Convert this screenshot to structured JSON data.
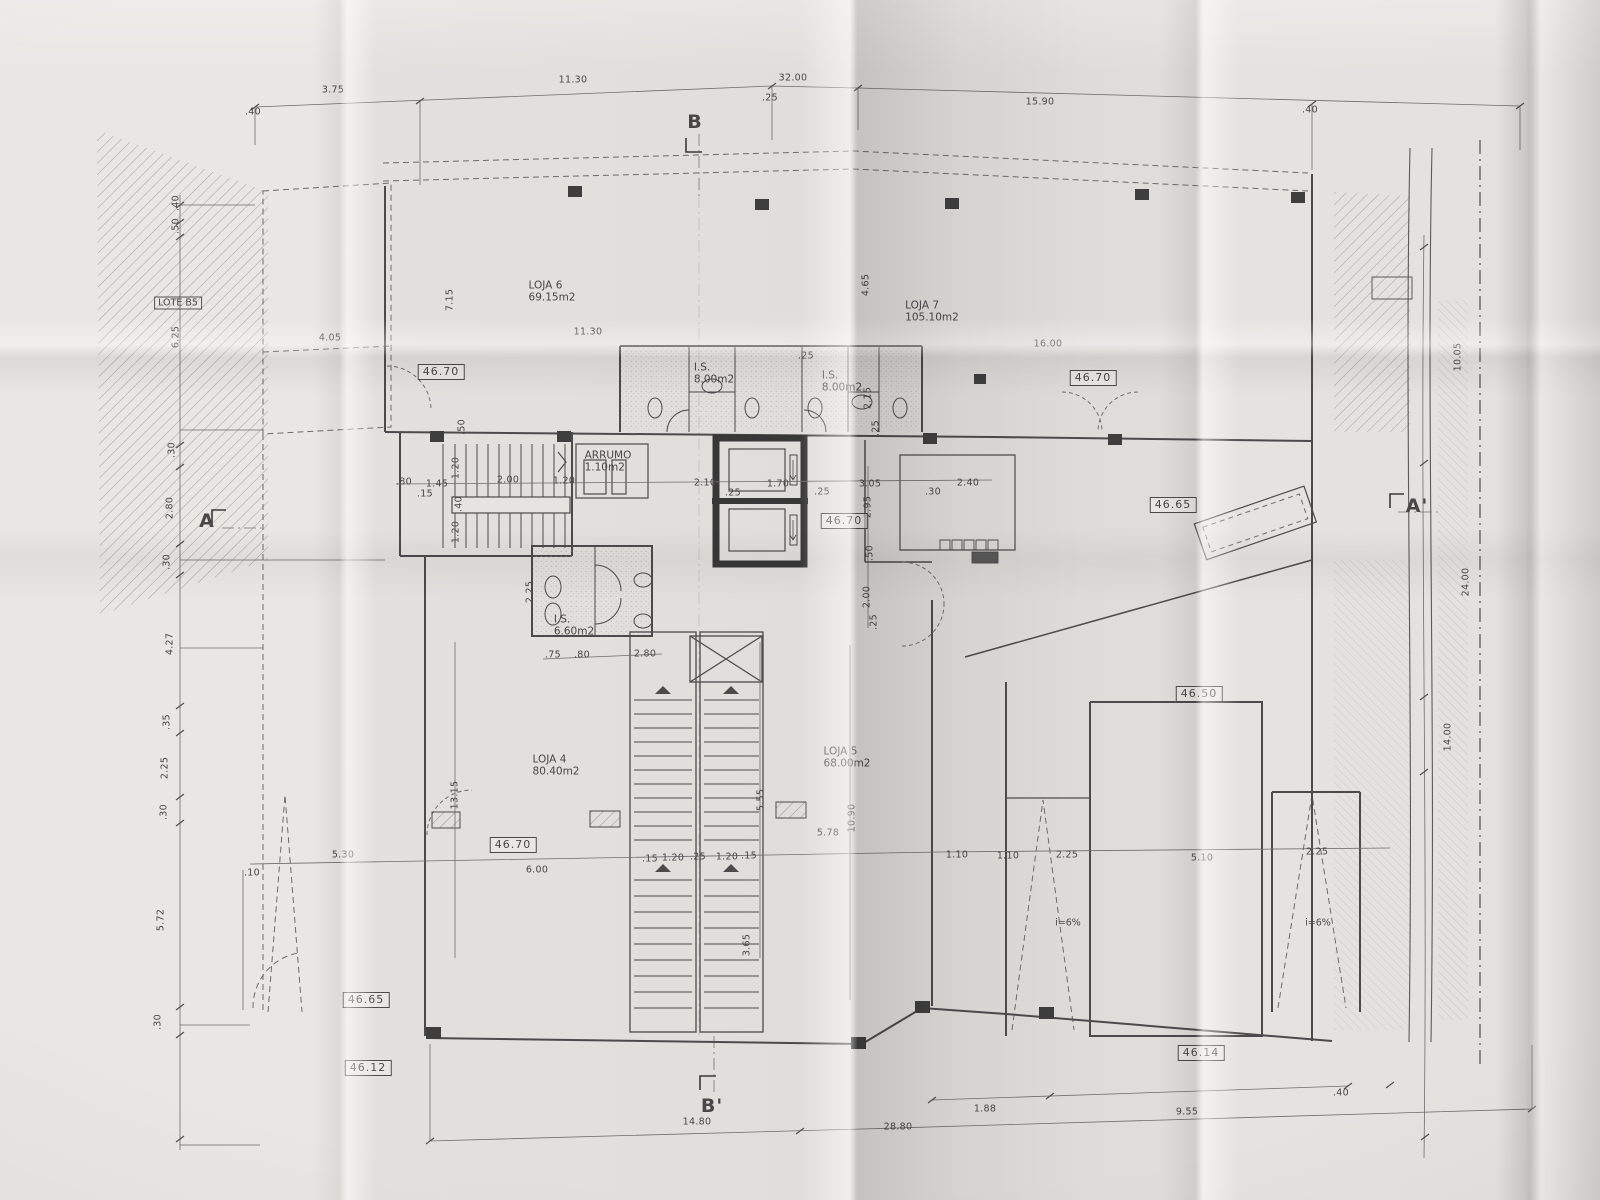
{
  "drawing": {
    "kind_note": "folded paper print of a ground-floor architectural plan",
    "accent_line_color": "#4b4b4b",
    "paper_color": "#e3e1de"
  },
  "annotations": {
    "rooms": [
      {
        "t": "LOJA 6",
        "t2": "69.15m2",
        "x": 552,
        "y": 292
      },
      {
        "t": "LOJA 7",
        "t2": "105.10m2",
        "x": 932,
        "y": 312
      },
      {
        "t": "LOJA 4",
        "t2": "80.40m2",
        "x": 556,
        "y": 766
      },
      {
        "t": "LOJA 5",
        "t2": "68.00m2",
        "x": 847,
        "y": 758
      },
      {
        "t": "I.S.",
        "t2": "8.00m2",
        "x": 714,
        "y": 374
      },
      {
        "t": "I.S.",
        "t2": "8.00m2",
        "x": 842,
        "y": 382
      },
      {
        "t": "I.S.",
        "t2": "6.60m2",
        "x": 574,
        "y": 626
      },
      {
        "t": "ARRUMO",
        "t2": "1.10m2",
        "x": 608,
        "y": 462
      }
    ],
    "levels": [
      {
        "t": "46.70",
        "x": 441,
        "y": 372
      },
      {
        "t": "46.70",
        "x": 1093,
        "y": 378
      },
      {
        "t": "46.70",
        "x": 844,
        "y": 521
      },
      {
        "t": "46.65",
        "x": 1173,
        "y": 505
      },
      {
        "t": "46.50",
        "x": 1199,
        "y": 694
      },
      {
        "t": "46.70",
        "x": 513,
        "y": 845
      },
      {
        "t": "46.65",
        "x": 366,
        "y": 1000
      },
      {
        "t": "46.12",
        "x": 368,
        "y": 1068
      },
      {
        "t": "46.14",
        "x": 1201,
        "y": 1053
      }
    ],
    "sections": [
      {
        "t": "B",
        "x": 695,
        "y": 122
      },
      {
        "t": "B'",
        "x": 712,
        "y": 1106
      },
      {
        "t": "A",
        "x": 207,
        "y": 521
      },
      {
        "t": "A'",
        "x": 1417,
        "y": 506
      }
    ],
    "misc": [
      {
        "t": "LOTE B5",
        "x": 178,
        "y": 303,
        "boxed": true
      },
      {
        "t": "i=6%",
        "x": 1068,
        "y": 923
      },
      {
        "t": "i=6%",
        "x": 1318,
        "y": 923
      }
    ],
    "dims": [
      {
        "t": ".40",
        "x": 253,
        "y": 112
      },
      {
        "t": "3.75",
        "x": 333,
        "y": 90
      },
      {
        "t": "11.30",
        "x": 573,
        "y": 80
      },
      {
        "t": "32.00",
        "x": 793,
        "y": 78
      },
      {
        "t": ".25",
        "x": 770,
        "y": 98
      },
      {
        "t": "15.90",
        "x": 1040,
        "y": 102
      },
      {
        "t": ".40",
        "x": 1310,
        "y": 110
      },
      {
        "t": "4.05",
        "x": 330,
        "y": 338
      },
      {
        "t": "11.30",
        "x": 588,
        "y": 332
      },
      {
        "t": "16.00",
        "x": 1048,
        "y": 344
      },
      {
        "t": "7.15",
        "x": 450,
        "y": 300,
        "r": -90
      },
      {
        "t": "4.65",
        "x": 866,
        "y": 285,
        "r": -90
      },
      {
        "t": ".40",
        "x": 176,
        "y": 203,
        "r": -90
      },
      {
        "t": ".50",
        "x": 176,
        "y": 226,
        "r": -90
      },
      {
        "t": "6.25",
        "x": 176,
        "y": 337,
        "r": -90
      },
      {
        "t": ".30",
        "x": 172,
        "y": 450,
        "r": -90
      },
      {
        "t": "2.80",
        "x": 170,
        "y": 508,
        "r": -90
      },
      {
        "t": ".30",
        "x": 167,
        "y": 562,
        "r": -90
      },
      {
        "t": "4.27",
        "x": 170,
        "y": 644,
        "r": -90
      },
      {
        "t": ".35",
        "x": 167,
        "y": 722,
        "r": -90
      },
      {
        "t": "2.25",
        "x": 165,
        "y": 768,
        "r": -90
      },
      {
        "t": ".30",
        "x": 164,
        "y": 812,
        "r": -90
      },
      {
        "t": "5.72",
        "x": 161,
        "y": 920,
        "r": -90
      },
      {
        "t": ".30",
        "x": 158,
        "y": 1022,
        "r": -90
      },
      {
        "t": ".10",
        "x": 252,
        "y": 873
      },
      {
        "t": ".80",
        "x": 404,
        "y": 482
      },
      {
        "t": "1.45",
        "x": 437,
        "y": 484
      },
      {
        "t": ".15",
        "x": 425,
        "y": 494
      },
      {
        "t": "1.20",
        "x": 456,
        "y": 468,
        "r": -90
      },
      {
        "t": "2.00",
        "x": 508,
        "y": 480
      },
      {
        "t": "1.20",
        "x": 564,
        "y": 481
      },
      {
        "t": ".40",
        "x": 459,
        "y": 504,
        "r": -90
      },
      {
        "t": "1.20",
        "x": 456,
        "y": 532,
        "r": -90
      },
      {
        "t": ".50",
        "x": 462,
        "y": 427,
        "r": -90
      },
      {
        "t": "2.10",
        "x": 705,
        "y": 483
      },
      {
        "t": ".25",
        "x": 733,
        "y": 493
      },
      {
        "t": "1.70",
        "x": 778,
        "y": 484
      },
      {
        "t": ".25",
        "x": 822,
        "y": 492
      },
      {
        "t": "3.05",
        "x": 870,
        "y": 484
      },
      {
        "t": ".30",
        "x": 933,
        "y": 492
      },
      {
        "t": "2.40",
        "x": 968,
        "y": 483
      },
      {
        "t": "2.95",
        "x": 868,
        "y": 507,
        "r": -90
      },
      {
        "t": ".50",
        "x": 870,
        "y": 553,
        "r": -90
      },
      {
        "t": "2.00",
        "x": 867,
        "y": 597,
        "r": -90
      },
      {
        "t": ".25",
        "x": 874,
        "y": 622,
        "r": -90
      },
      {
        "t": "2.15",
        "x": 868,
        "y": 398,
        "r": -90
      },
      {
        "t": ".25",
        "x": 876,
        "y": 428,
        "r": -90
      },
      {
        "t": ".25",
        "x": 806,
        "y": 356
      },
      {
        "t": "2.25",
        "x": 530,
        "y": 592,
        "r": -90
      },
      {
        "t": ".75",
        "x": 553,
        "y": 655
      },
      {
        "t": ".80",
        "x": 582,
        "y": 655
      },
      {
        "t": "2.80",
        "x": 645,
        "y": 654
      },
      {
        "t": "13.15",
        "x": 455,
        "y": 795,
        "r": -90
      },
      {
        "t": "5.55",
        "x": 761,
        "y": 800,
        "r": -90
      },
      {
        "t": "3.65",
        "x": 747,
        "y": 945,
        "r": -90
      },
      {
        "t": "10.90",
        "x": 852,
        "y": 818,
        "r": -90
      },
      {
        "t": "5.30",
        "x": 343,
        "y": 855
      },
      {
        "t": "6.00",
        "x": 537,
        "y": 870
      },
      {
        "t": "5.78",
        "x": 828,
        "y": 833
      },
      {
        "t": ".15",
        "x": 650,
        "y": 859
      },
      {
        "t": "1.20",
        "x": 673,
        "y": 858
      },
      {
        "t": ".25",
        "x": 698,
        "y": 857
      },
      {
        "t": "1.20",
        "x": 727,
        "y": 857
      },
      {
        "t": ".15",
        "x": 749,
        "y": 856
      },
      {
        "t": "1.10",
        "x": 957,
        "y": 855
      },
      {
        "t": "1.10",
        "x": 1008,
        "y": 856
      },
      {
        "t": "2.25",
        "x": 1067,
        "y": 855
      },
      {
        "t": "5.10",
        "x": 1202,
        "y": 858
      },
      {
        "t": "2.25",
        "x": 1317,
        "y": 852
      },
      {
        "t": "10.05",
        "x": 1458,
        "y": 357,
        "r": -90
      },
      {
        "t": "24.00",
        "x": 1466,
        "y": 582,
        "r": -90
      },
      {
        "t": "14.00",
        "x": 1448,
        "y": 737,
        "r": -90
      },
      {
        "t": "14.80",
        "x": 697,
        "y": 1122
      },
      {
        "t": "28.80",
        "x": 898,
        "y": 1127
      },
      {
        "t": "1.88",
        "x": 985,
        "y": 1109
      },
      {
        "t": "9.55",
        "x": 1187,
        "y": 1112
      },
      {
        "t": ".40",
        "x": 1341,
        "y": 1093
      }
    ]
  }
}
